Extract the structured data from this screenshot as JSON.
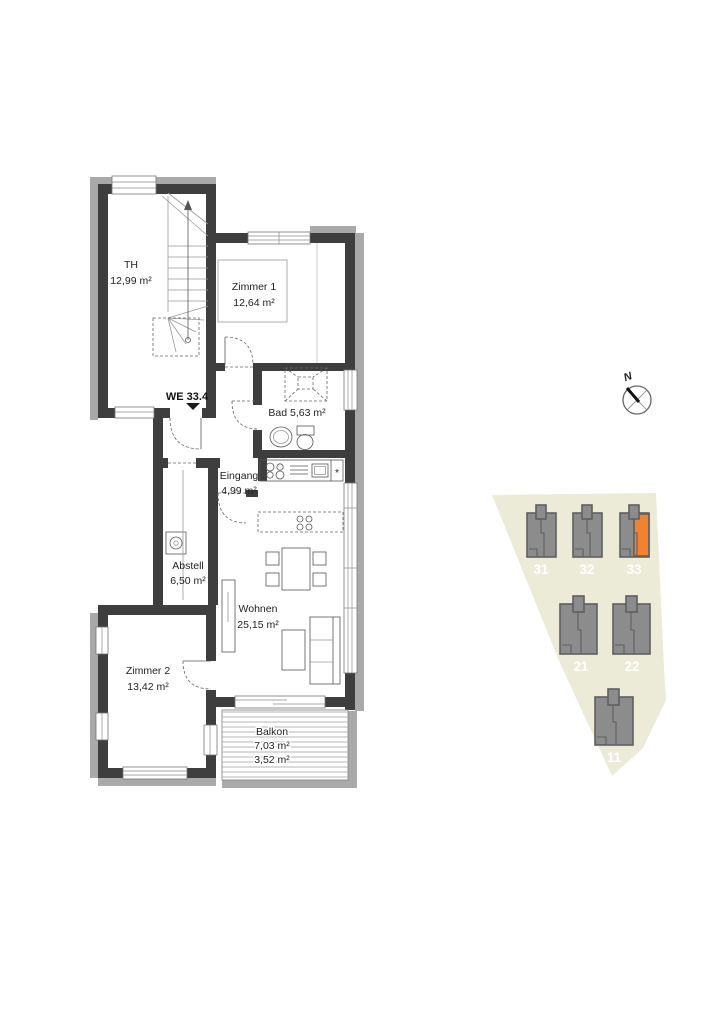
{
  "floorplan": {
    "unit_label": "WE 33.4",
    "rooms": {
      "th": {
        "name": "TH",
        "area": "12,99 m²"
      },
      "zimmer1": {
        "name": "Zimmer 1",
        "area": "12,64 m²"
      },
      "bad": {
        "label": "Bad 5,63 m²"
      },
      "eingang": {
        "name": "Eingang",
        "area": "4,99 m²"
      },
      "abstell": {
        "name": "Abstell",
        "area": "6,50 m²"
      },
      "wohnen": {
        "name": "Wohnen",
        "area": "25,15 m²"
      },
      "zimmer2": {
        "name": "Zimmer 2",
        "area": "13,42 m²"
      },
      "balkon": {
        "name": "Balkon",
        "area_full": "7,03 m²",
        "area_half": "3,52 m²"
      }
    },
    "kitchen_note": "*"
  },
  "siteplan": {
    "buildings": [
      {
        "id": "31",
        "highlighted": false
      },
      {
        "id": "32",
        "highlighted": false
      },
      {
        "id": "33",
        "highlighted": true
      },
      {
        "id": "21",
        "highlighted": false
      },
      {
        "id": "22",
        "highlighted": false
      },
      {
        "id": "11",
        "highlighted": false
      }
    ],
    "colors": {
      "site": "#ebebd8",
      "building": "#8c8c8c",
      "building_outline": "#5f5f5f",
      "highlight": "#f08232"
    }
  },
  "compass": {
    "north_label": "N"
  },
  "colors": {
    "wall": "#3e3e3e",
    "shadow": "#a9a9a9"
  }
}
